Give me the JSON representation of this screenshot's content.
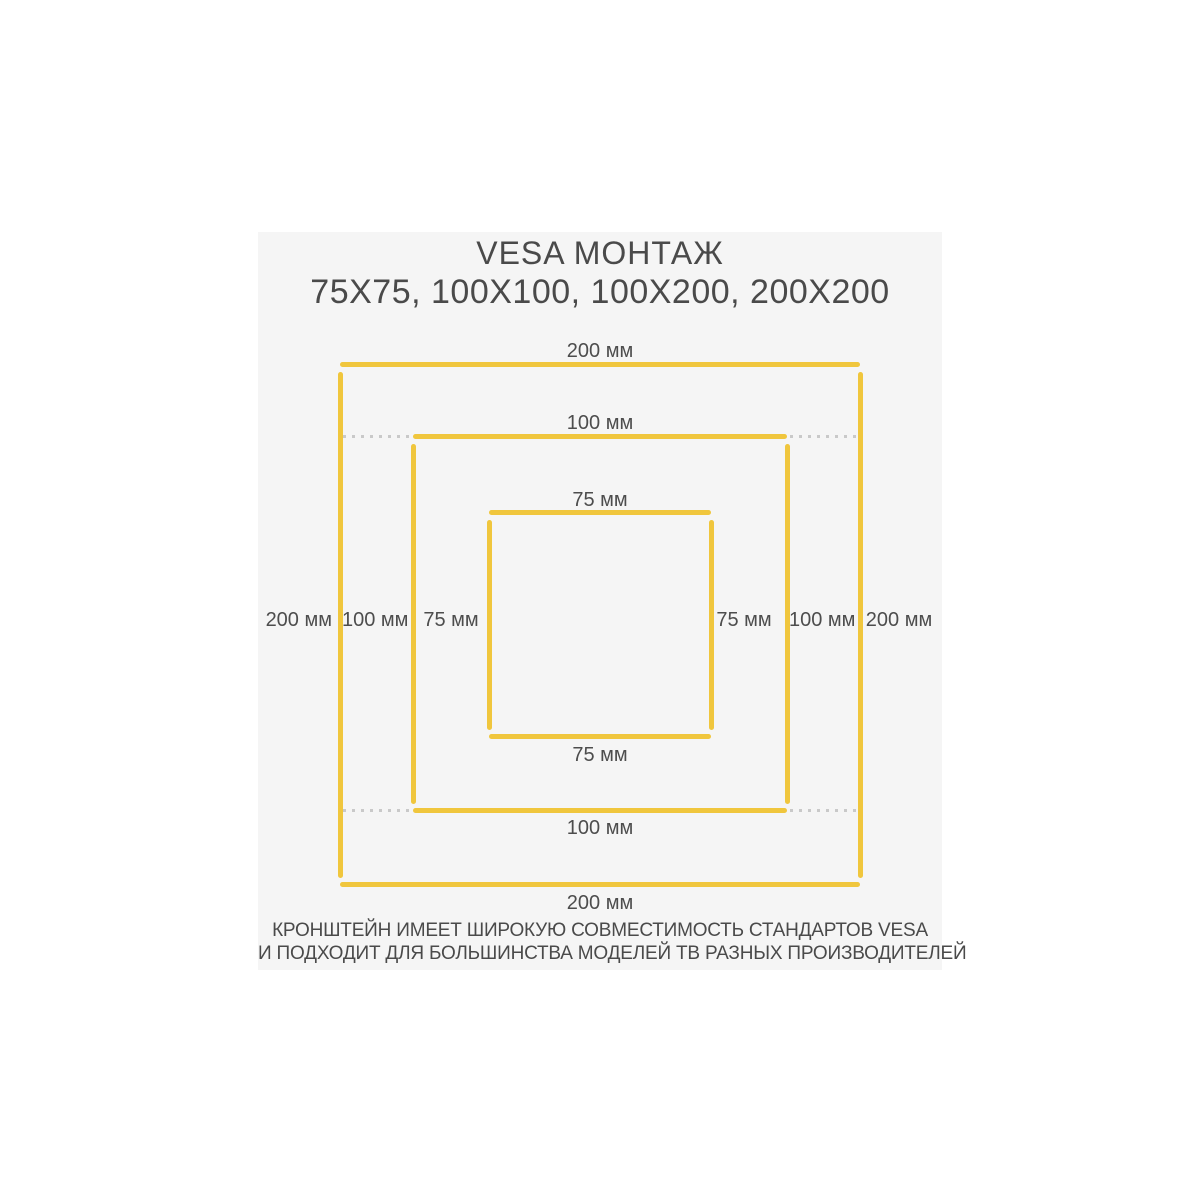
{
  "title": {
    "line1": "VESA МОНТАЖ",
    "line2": "75X75, 100X100, 100X200, 200X200"
  },
  "diagram": {
    "type": "nested-squares",
    "unit": "мм",
    "standards": [
      "75X75",
      "100X100",
      "100X200",
      "200X200"
    ],
    "squares": [
      {
        "id": "vesa-200",
        "mm": 200,
        "label": "200 мм"
      },
      {
        "id": "vesa-100",
        "mm": 100,
        "label": "100 мм"
      },
      {
        "id": "vesa-75",
        "mm": 75,
        "label": "75 мм"
      }
    ],
    "colors": {
      "square_line": "#f0c63d",
      "extension_dots": "#c9c9c9",
      "label_text": "#4d4d4d"
    }
  },
  "footer": {
    "line1": "КРОНШТЕЙН ИМЕЕТ ШИРОКУЮ СОВМЕСТИМОСТЬ СТАНДАРТОВ VESA",
    "line2": "И ПОДХОДИТ ДЛЯ БОЛЬШИНСТВА МОДЕЛЕЙ ТВ РАЗНЫХ ПРОИЗВОДИТЕЛЕЙ"
  },
  "colors": {
    "page_bg": "#ffffff",
    "panel_bg": "#f5f5f5",
    "title_text": "#4a4a4a"
  }
}
